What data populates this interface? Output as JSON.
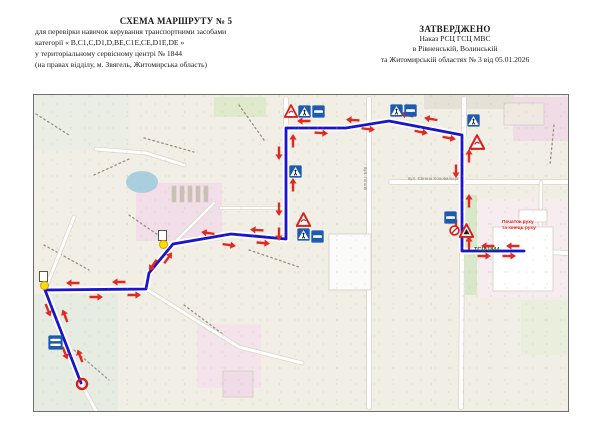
{
  "header": {
    "left": {
      "title": "СХЕМА МАРШРУТУ № 5",
      "lines": [
        "для перевірки навичок керування транспортними засобами",
        "категорії « В,С1,С,D1,D,ВЕ,С1Е,СЕ,D1Е,DЕ »",
        "у територіальному сервісному центрі № 1844",
        "(на правах відділу, м. Звягель, Житомирська область)"
      ]
    },
    "right": {
      "title": "ЗАТВЕРДЖЕНО",
      "lines": [
        "Наказ РСЦ ГСЦ МВС",
        "в Рівненській, Волинській",
        "та Житомирській областях № 3 від 05.01.2026"
      ]
    }
  },
  "map": {
    "colors": {
      "base": "#f1eee5",
      "roadFill": "#ffffff",
      "roadEdge": "#ddd6c8",
      "route": "#1a15c9",
      "arrow": "#e2291f",
      "signBlue": "#1c5bb0",
      "signRed": "#d62020",
      "treeline": "#9a917f",
      "buildingStroke": "#cfc8bd"
    },
    "zones": [
      {
        "x": 0,
        "y": 0,
        "w": 95,
        "h": 55,
        "c": "#ebeee4"
      },
      {
        "x": 390,
        "y": 0,
        "w": 90,
        "h": 14,
        "c": "#e6e1d7"
      },
      {
        "x": 180,
        "y": 2,
        "w": 52,
        "h": 20,
        "c": "#dfe9cb"
      },
      {
        "x": 479,
        "y": 2,
        "w": 55,
        "h": 44,
        "c": "#f0dce6"
      },
      {
        "x": 102,
        "y": 88,
        "w": 86,
        "h": 58,
        "c": "#f2dee8"
      },
      {
        "x": 445,
        "y": 104,
        "w": 89,
        "h": 98,
        "c": "#f7ecf0"
      },
      {
        "x": 431,
        "y": 100,
        "w": 12,
        "h": 100,
        "c": "#d8e7c9"
      },
      {
        "x": 0,
        "y": 199,
        "w": 84,
        "h": 117,
        "c": "#e7ece2"
      },
      {
        "x": 163,
        "y": 229,
        "w": 64,
        "h": 64,
        "c": "#f4e3eb"
      },
      {
        "x": 487,
        "y": 205,
        "w": 47,
        "h": 55,
        "c": "#eaeedd"
      }
    ],
    "pond": {
      "cx": 108,
      "cy": 87,
      "rx": 16,
      "ry": 11
    },
    "treelines": [
      [
        2,
        19,
        35,
        40
      ],
      [
        110,
        43,
        160,
        57
      ],
      [
        60,
        80,
        95,
        64
      ],
      [
        10,
        150,
        55,
        175
      ],
      [
        40,
        255,
        75,
        285
      ],
      [
        150,
        210,
        190,
        240
      ],
      [
        205,
        10,
        230,
        45
      ],
      [
        520,
        30,
        516,
        70
      ],
      [
        95,
        120,
        127,
        142
      ],
      [
        215,
        155,
        265,
        172
      ]
    ],
    "roads": [
      {
        "pts": [
          [
            252,
            4
          ],
          [
            252,
            33
          ]
        ],
        "w": 4
      },
      {
        "pts": [
          [
            335,
            4
          ],
          [
            335,
            312
          ]
        ],
        "w": 4
      },
      {
        "pts": [
          [
            430,
            4
          ],
          [
            430,
            40
          ]
        ],
        "w": 4
      },
      {
        "pts": [
          [
            428,
            156
          ],
          [
            427,
            312
          ]
        ],
        "w": 4
      },
      {
        "pts": [
          [
            490,
            156
          ],
          [
            534,
            158
          ]
        ],
        "w": 4
      },
      {
        "pts": [
          [
            357,
            87
          ],
          [
            534,
            87
          ]
        ],
        "w": 4
      },
      {
        "pts": [
          [
            11,
            195
          ],
          [
            40,
            122
          ]
        ],
        "w": 3
      },
      {
        "pts": [
          [
            47,
            288
          ],
          [
            62,
            316
          ]
        ],
        "w": 3
      },
      {
        "pts": [
          [
            112,
            194
          ],
          [
            205,
            252
          ],
          [
            268,
            268
          ]
        ],
        "w": 3
      },
      {
        "pts": [
          [
            62,
            54
          ],
          [
            112,
            58
          ],
          [
            150,
            70
          ]
        ],
        "w": 3
      },
      {
        "pts": [
          [
            187,
            113
          ],
          [
            252,
            113
          ]
        ],
        "w": 2.5
      },
      {
        "pts": [
          [
            507,
            87
          ],
          [
            506,
            156
          ]
        ],
        "w": 2.5
      },
      {
        "pts": [
          [
            139,
            149
          ],
          [
            180,
            108
          ]
        ],
        "w": 2.5
      }
    ],
    "buildings": [
      {
        "x": 138,
        "y": 91,
        "w": 4,
        "h": 16,
        "c": "#c9c0b2"
      },
      {
        "x": 146,
        "y": 91,
        "w": 4,
        "h": 16,
        "c": "#c9c0b2"
      },
      {
        "x": 154,
        "y": 91,
        "w": 4,
        "h": 16,
        "c": "#c9c0b2"
      },
      {
        "x": 162,
        "y": 91,
        "w": 4,
        "h": 16,
        "c": "#c9c0b2"
      },
      {
        "x": 170,
        "y": 91,
        "w": 4,
        "h": 16,
        "c": "#c9c0b2"
      },
      {
        "x": 459,
        "y": 132,
        "w": 60,
        "h": 64,
        "c": "#ffffff"
      },
      {
        "x": 295,
        "y": 139,
        "w": 42,
        "h": 56,
        "c": "#fbfbfa"
      },
      {
        "x": 470,
        "y": 8,
        "w": 40,
        "h": 22,
        "c": "#efe9e2"
      },
      {
        "x": 485,
        "y": 115,
        "w": 28,
        "h": 12,
        "c": "#ffffff"
      },
      {
        "x": 189,
        "y": 276,
        "w": 30,
        "h": 26,
        "c": "#f0dce6"
      }
    ],
    "route": {
      "points": [
        [
          490,
          156
        ],
        [
          428,
          156
        ],
        [
          428,
          40
        ],
        [
          355,
          26
        ],
        [
          312,
          33
        ],
        [
          252,
          33
        ],
        [
          252,
          144
        ],
        [
          197,
          139
        ],
        [
          139,
          149
        ],
        [
          115,
          178
        ],
        [
          112,
          194
        ],
        [
          11,
          195
        ],
        [
          47,
          288
        ]
      ]
    },
    "arrows": [
      [
        454,
        151,
        180
      ],
      [
        479,
        151,
        180
      ],
      [
        450,
        161,
        0
      ],
      [
        475,
        161,
        0
      ],
      [
        422,
        76,
        90
      ],
      [
        422,
        131,
        90
      ],
      [
        435,
        61,
        270
      ],
      [
        435,
        106,
        270
      ],
      [
        435,
        148,
        270
      ],
      [
        397,
        24,
        190
      ],
      [
        373,
        20,
        192
      ],
      [
        387,
        37,
        10
      ],
      [
        415,
        43,
        10
      ],
      [
        319,
        25,
        184
      ],
      [
        270,
        26,
        180
      ],
      [
        287,
        38,
        4
      ],
      [
        334,
        34,
        6
      ],
      [
        245,
        58,
        90
      ],
      [
        245,
        114,
        90
      ],
      [
        259,
        46,
        270
      ],
      [
        259,
        90,
        270
      ],
      [
        245,
        139,
        90
      ],
      [
        223,
        135,
        184
      ],
      [
        174,
        138,
        188
      ],
      [
        195,
        150,
        8
      ],
      [
        229,
        148,
        5
      ],
      [
        119,
        170,
        125
      ],
      [
        134,
        163,
        305
      ],
      [
        85,
        187,
        180
      ],
      [
        39,
        188,
        180
      ],
      [
        62,
        202,
        0
      ],
      [
        100,
        200,
        0
      ],
      [
        14,
        215,
        69
      ],
      [
        31,
        258,
        69
      ],
      [
        31,
        221,
        249
      ],
      [
        46,
        261,
        249
      ]
    ],
    "signs": [
      {
        "t": "warning",
        "x": 250,
        "y": 9,
        "s": 14
      },
      {
        "t": "crosswalk",
        "x": 264,
        "y": 10,
        "s": 13
      },
      {
        "t": "bump",
        "x": 278,
        "y": 10,
        "s": 13
      },
      {
        "t": "crosswalk",
        "x": 356,
        "y": 9,
        "s": 13
      },
      {
        "t": "bump",
        "x": 370,
        "y": 9,
        "s": 13
      },
      {
        "t": "crosswalk",
        "x": 433,
        "y": 19,
        "s": 13
      },
      {
        "t": "warning",
        "x": 435,
        "y": 39,
        "s": 16
      },
      {
        "t": "crosswalk",
        "x": 255,
        "y": 70,
        "s": 13
      },
      {
        "t": "warning",
        "x": 262,
        "y": 117,
        "s": 15
      },
      {
        "t": "crosswalk",
        "x": 263,
        "y": 133,
        "s": 13
      },
      {
        "t": "bump",
        "x": 277,
        "y": 135,
        "s": 13
      },
      {
        "t": "bump",
        "x": 410,
        "y": 116,
        "s": 13
      },
      {
        "t": "no-stop",
        "x": 415,
        "y": 130,
        "s": 11
      },
      {
        "t": "warning-dark",
        "x": 425,
        "y": 128,
        "s": 15
      },
      {
        "t": "double-bar",
        "x": 14,
        "y": 240,
        "s": 15
      }
    ],
    "traffic_lights": [
      {
        "x": 129,
        "y": 149
      },
      {
        "x": 10,
        "y": 190
      }
    ],
    "end_marker": {
      "x": 48,
      "y": 289
    },
    "labels": [
      {
        "text": "Початок руху",
        "x": 468,
        "y": 125,
        "size": 6,
        "color": "#e02616",
        "bold": true,
        "angle": 0,
        "scale": 0.8
      },
      {
        "text": "та кінець руху",
        "x": 468,
        "y": 131,
        "size": 6,
        "color": "#e02616",
        "bold": true,
        "angle": 0,
        "scale": 0.8
      },
      {
        "text": "ТСЦ 1844",
        "x": 440,
        "y": 152,
        "size": 7,
        "color": "#1e6b1e",
        "bold": true,
        "angle": 0,
        "scale": 0.8
      },
      {
        "text": "вул. Гоголя",
        "x": 333,
        "y": 72,
        "size": 6,
        "color": "#8a8378",
        "bold": false,
        "angle": 90,
        "scale": 0.75
      },
      {
        "text": "вул. Євгена Коновальця",
        "x": 374,
        "y": 82,
        "size": 6,
        "color": "#8a8378",
        "bold": false,
        "angle": 0,
        "scale": 0.75
      }
    ]
  }
}
